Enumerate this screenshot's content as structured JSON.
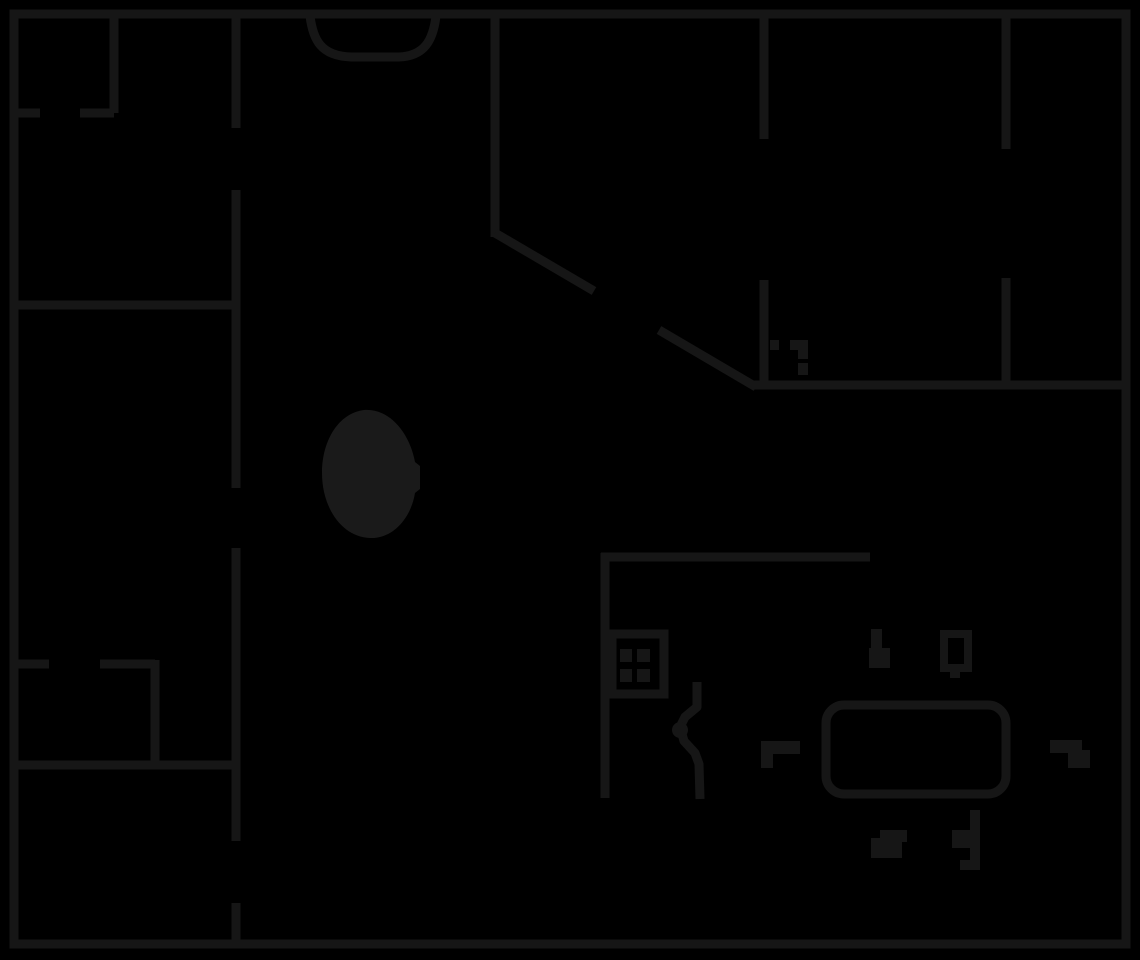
{
  "canvas": {
    "width": 1140,
    "height": 960,
    "background": "#000000"
  },
  "style": {
    "wall_color": "#161616",
    "fixture_color": "#161616",
    "blob_color": "#1a1a1a",
    "wall_thickness": 9
  },
  "walls": {
    "outer_rect": [
      14,
      14,
      1112,
      930
    ],
    "segments": [
      {
        "name": "wall-topleft-room-right",
        "x1": 114,
        "y1": 14,
        "x2": 114,
        "y2": 113
      },
      {
        "name": "wall-topleft-room-bottom-a",
        "x1": 14,
        "y1": 113,
        "x2": 40,
        "y2": 113
      },
      {
        "name": "wall-topleft-room-bottom-b",
        "x1": 80,
        "y1": 113,
        "x2": 114,
        "y2": 113
      },
      {
        "name": "wall-left-corridor-a",
        "x1": 236,
        "y1": 14,
        "x2": 236,
        "y2": 128
      },
      {
        "name": "wall-left-corridor-b",
        "x1": 236,
        "y1": 190,
        "x2": 236,
        "y2": 488
      },
      {
        "name": "wall-left-corridor-c",
        "x1": 236,
        "y1": 548,
        "x2": 236,
        "y2": 841
      },
      {
        "name": "wall-left-corridor-d",
        "x1": 236,
        "y1": 903,
        "x2": 236,
        "y2": 944
      },
      {
        "name": "wall-left-room-divider",
        "x1": 14,
        "y1": 305,
        "x2": 236,
        "y2": 305
      },
      {
        "name": "wall-closet-top-a",
        "x1": 14,
        "y1": 664,
        "x2": 49,
        "y2": 664
      },
      {
        "name": "wall-closet-top-b",
        "x1": 100,
        "y1": 664,
        "x2": 155,
        "y2": 664
      },
      {
        "name": "wall-closet-right",
        "x1": 155,
        "y1": 660,
        "x2": 155,
        "y2": 765
      },
      {
        "name": "wall-closet-bottom",
        "x1": 14,
        "y1": 765,
        "x2": 236,
        "y2": 765
      },
      {
        "name": "wall-top-center",
        "x1": 495,
        "y1": 14,
        "x2": 495,
        "y2": 237
      },
      {
        "name": "wall-topright-1a",
        "x1": 764,
        "y1": 14,
        "x2": 764,
        "y2": 139
      },
      {
        "name": "wall-topright-1b",
        "x1": 764,
        "y1": 280,
        "x2": 764,
        "y2": 389
      },
      {
        "name": "wall-topright-2a",
        "x1": 1006,
        "y1": 14,
        "x2": 1006,
        "y2": 149
      },
      {
        "name": "wall-topright-2b",
        "x1": 1006,
        "y1": 278,
        "x2": 1006,
        "y2": 385
      },
      {
        "name": "wall-right-horizontal",
        "x1": 752,
        "y1": 385,
        "x2": 1126,
        "y2": 385
      },
      {
        "name": "wall-kitchen-top",
        "x1": 601,
        "y1": 557,
        "x2": 870,
        "y2": 557
      },
      {
        "name": "wall-kitchen-left",
        "x1": 605,
        "y1": 553,
        "x2": 605,
        "y2": 798
      }
    ],
    "diagonal_segments": [
      {
        "name": "wall-diagonal-a",
        "x1": 495,
        "y1": 233,
        "x2": 594,
        "y2": 291
      },
      {
        "name": "wall-diagonal-b",
        "x1": 659,
        "y1": 330,
        "x2": 756,
        "y2": 387
      }
    ]
  },
  "door_arc": {
    "name": "door-swing-arc",
    "d": "M 310 16 C 313 40 321 56 351 57 L 399 57 C 424 56 433 41 436 16"
  },
  "fixtures": [
    {
      "name": "oval-fixture",
      "type": "path-fill",
      "color_key": "blob_color",
      "d": "M 364 410 C 339 413 322 440 322 473 C 322 508 342 537 370 538 C 393 539 411 518 415 493 L 420 489 L 420 466 L 415 462 C 410 434 390 408 364 410 Z"
    },
    {
      "name": "stove-frame",
      "type": "rect-outline",
      "rect": [
        612,
        634,
        52,
        60
      ]
    },
    {
      "name": "stove-burner-1",
      "type": "rect-fill",
      "rect": [
        620,
        649,
        12,
        13
      ]
    },
    {
      "name": "stove-burner-2",
      "type": "rect-fill",
      "rect": [
        637,
        649,
        13,
        13
      ]
    },
    {
      "name": "stove-burner-3",
      "type": "rect-fill",
      "rect": [
        620,
        669,
        12,
        13
      ]
    },
    {
      "name": "stove-burner-4",
      "type": "rect-fill",
      "rect": [
        637,
        669,
        13,
        13
      ]
    },
    {
      "name": "door-jamb-tick",
      "type": "rect-fill",
      "rect": [
        770,
        340,
        9,
        10
      ]
    },
    {
      "name": "door-jamb-bar",
      "type": "rect-fill",
      "rect": [
        790,
        340,
        18,
        10
      ]
    },
    {
      "name": "door-jamb-step",
      "type": "rect-fill",
      "rect": [
        798,
        350,
        10,
        9
      ]
    },
    {
      "name": "door-jamb-block",
      "type": "rect-fill",
      "rect": [
        798,
        363,
        10,
        12
      ]
    },
    {
      "name": "squiggle-decor",
      "type": "path-stroke",
      "d": "M 697 682 L 697 707 L 685 717 L 680 727 L 684 741 L 695 753 L 699 764 L 700 799"
    },
    {
      "name": "squiggle-knob",
      "type": "circle-fill",
      "circle": [
        680,
        730,
        8
      ]
    },
    {
      "name": "dash-decor-left-bar",
      "type": "rect-fill",
      "rect": [
        761,
        741,
        39,
        13
      ]
    },
    {
      "name": "dash-decor-left-leg",
      "type": "rect-fill",
      "rect": [
        761,
        754,
        12,
        14
      ]
    },
    {
      "name": "sofa-outline",
      "type": "rect-outline",
      "rect": [
        826,
        705,
        180,
        89
      ],
      "rx": 18
    },
    {
      "name": "candle-decor-stem",
      "type": "rect-fill",
      "rect": [
        871,
        629,
        11,
        20
      ]
    },
    {
      "name": "candle-decor-base",
      "type": "rect-fill",
      "rect": [
        869,
        648,
        21,
        20
      ]
    },
    {
      "name": "mug-decor-frame",
      "type": "rect-outline",
      "rect": [
        944,
        634,
        24,
        34
      ],
      "stroke": 8
    },
    {
      "name": "mug-decor-tab",
      "type": "rect-fill",
      "rect": [
        950,
        667,
        10,
        11
      ]
    },
    {
      "name": "dash-decor-right-bar",
      "type": "rect-fill",
      "rect": [
        1050,
        740,
        32,
        13
      ]
    },
    {
      "name": "dash-decor-right-leg",
      "type": "rect-fill",
      "rect": [
        1068,
        750,
        22,
        18
      ]
    },
    {
      "name": "shoe-decor-top",
      "type": "rect-fill",
      "rect": [
        880,
        830,
        27,
        12
      ]
    },
    {
      "name": "shoe-decor-base",
      "type": "rect-fill",
      "rect": [
        871,
        838,
        31,
        20
      ]
    },
    {
      "name": "note-decor-bar",
      "type": "rect-fill",
      "rect": [
        970,
        810,
        10,
        60
      ]
    },
    {
      "name": "note-decor-bulge",
      "type": "rect-fill",
      "rect": [
        952,
        830,
        18,
        18
      ]
    },
    {
      "name": "note-decor-foot",
      "type": "rect-fill",
      "rect": [
        960,
        860,
        10,
        10
      ]
    }
  ]
}
